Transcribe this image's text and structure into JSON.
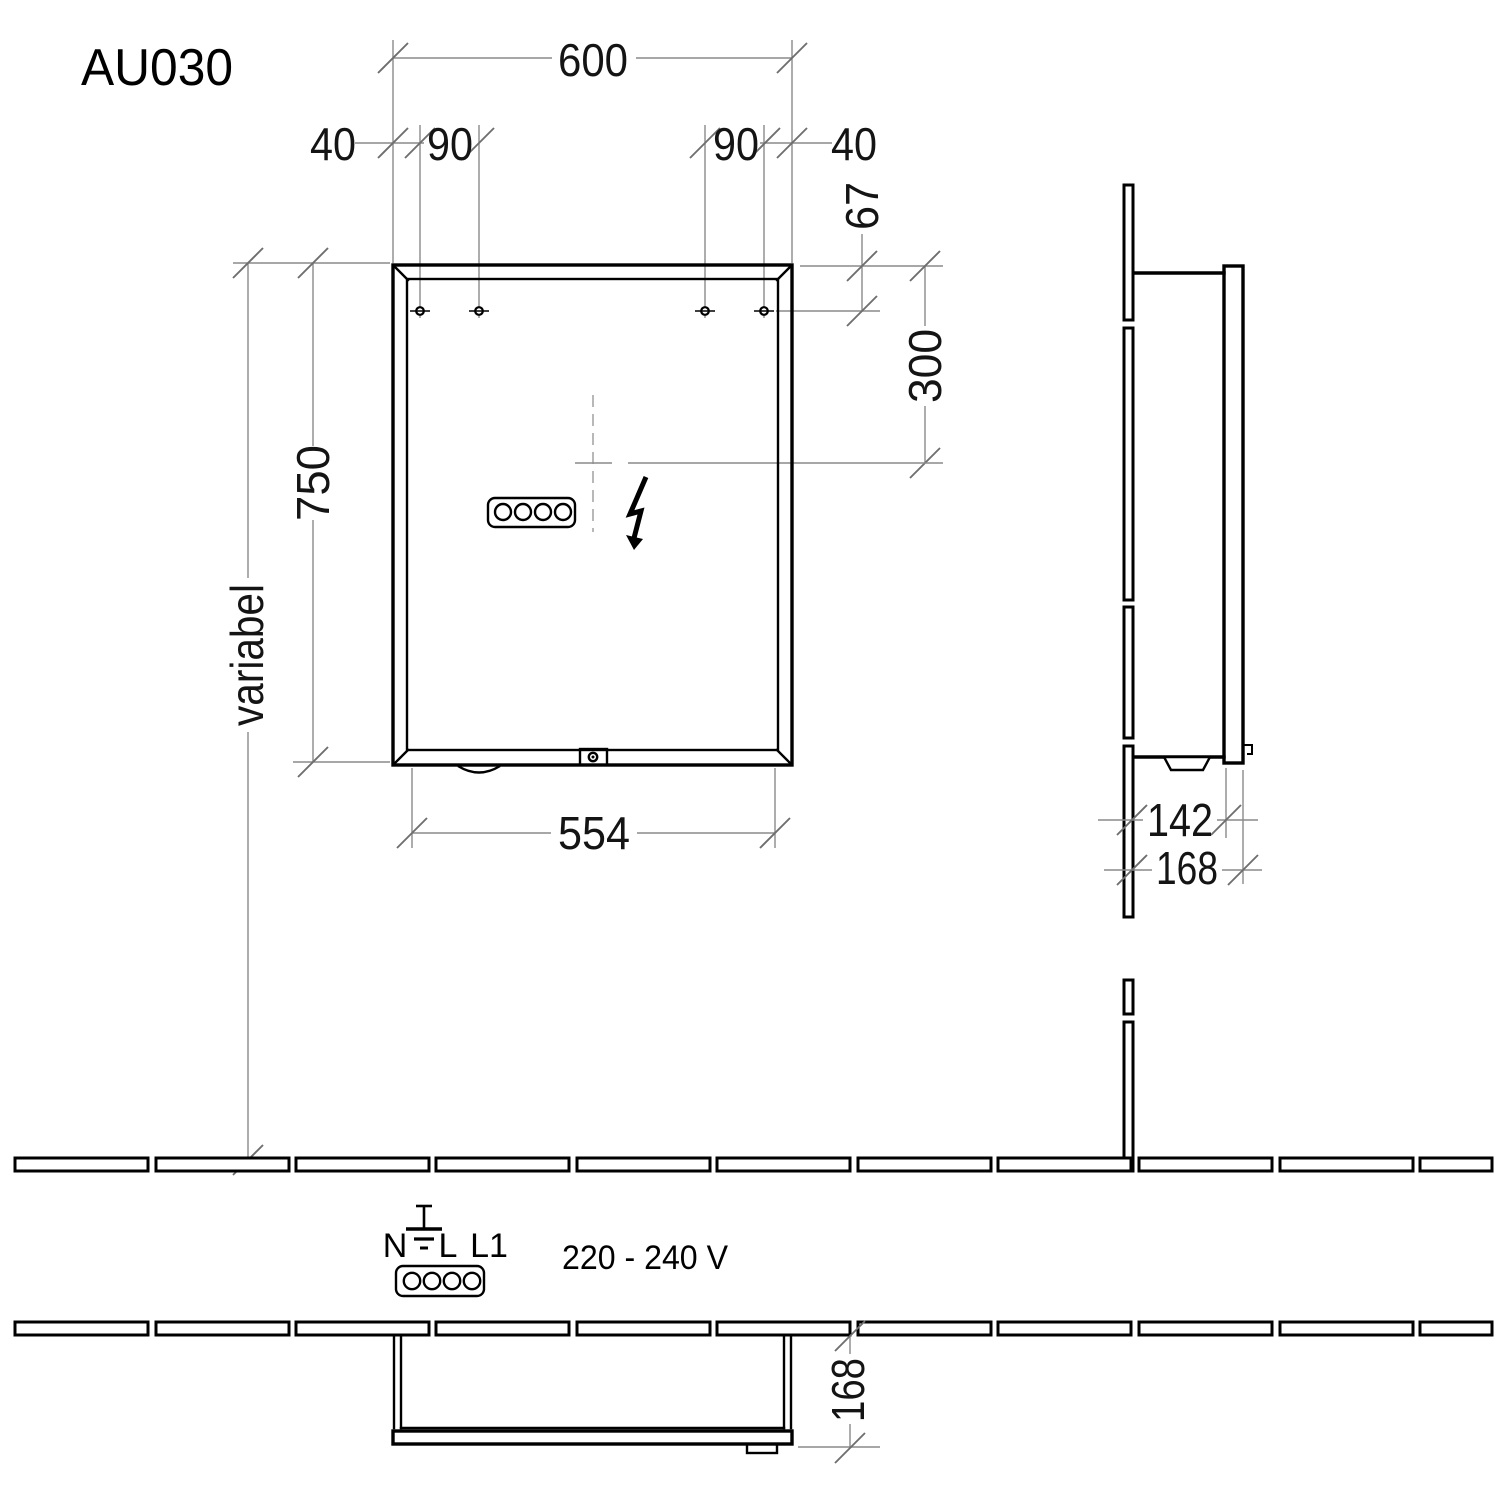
{
  "title": {
    "model": "AU030"
  },
  "front_view": {
    "width": "600",
    "hole_offsets": [
      "40",
      "90",
      "90",
      "40"
    ],
    "hole_top_offset": "67",
    "outlet_center_from_top": "300",
    "height": "750",
    "mounting_height": "variabel",
    "inner_width_bottom": "554"
  },
  "side_view": {
    "body_depth": "142",
    "total_depth": "168"
  },
  "bottom_view": {
    "total_depth": "168"
  },
  "electrical": {
    "terminal_labels": [
      "N",
      "L",
      "L1"
    ],
    "voltage_range": "220 - 240 V",
    "symbols": {
      "earth": "earth-ground-symbol",
      "power": "lightning-bolt-symbol"
    }
  },
  "colors": {
    "line": "#000000",
    "dimension": "#8a8a8a",
    "text": "#141414",
    "background": "#ffffff"
  }
}
